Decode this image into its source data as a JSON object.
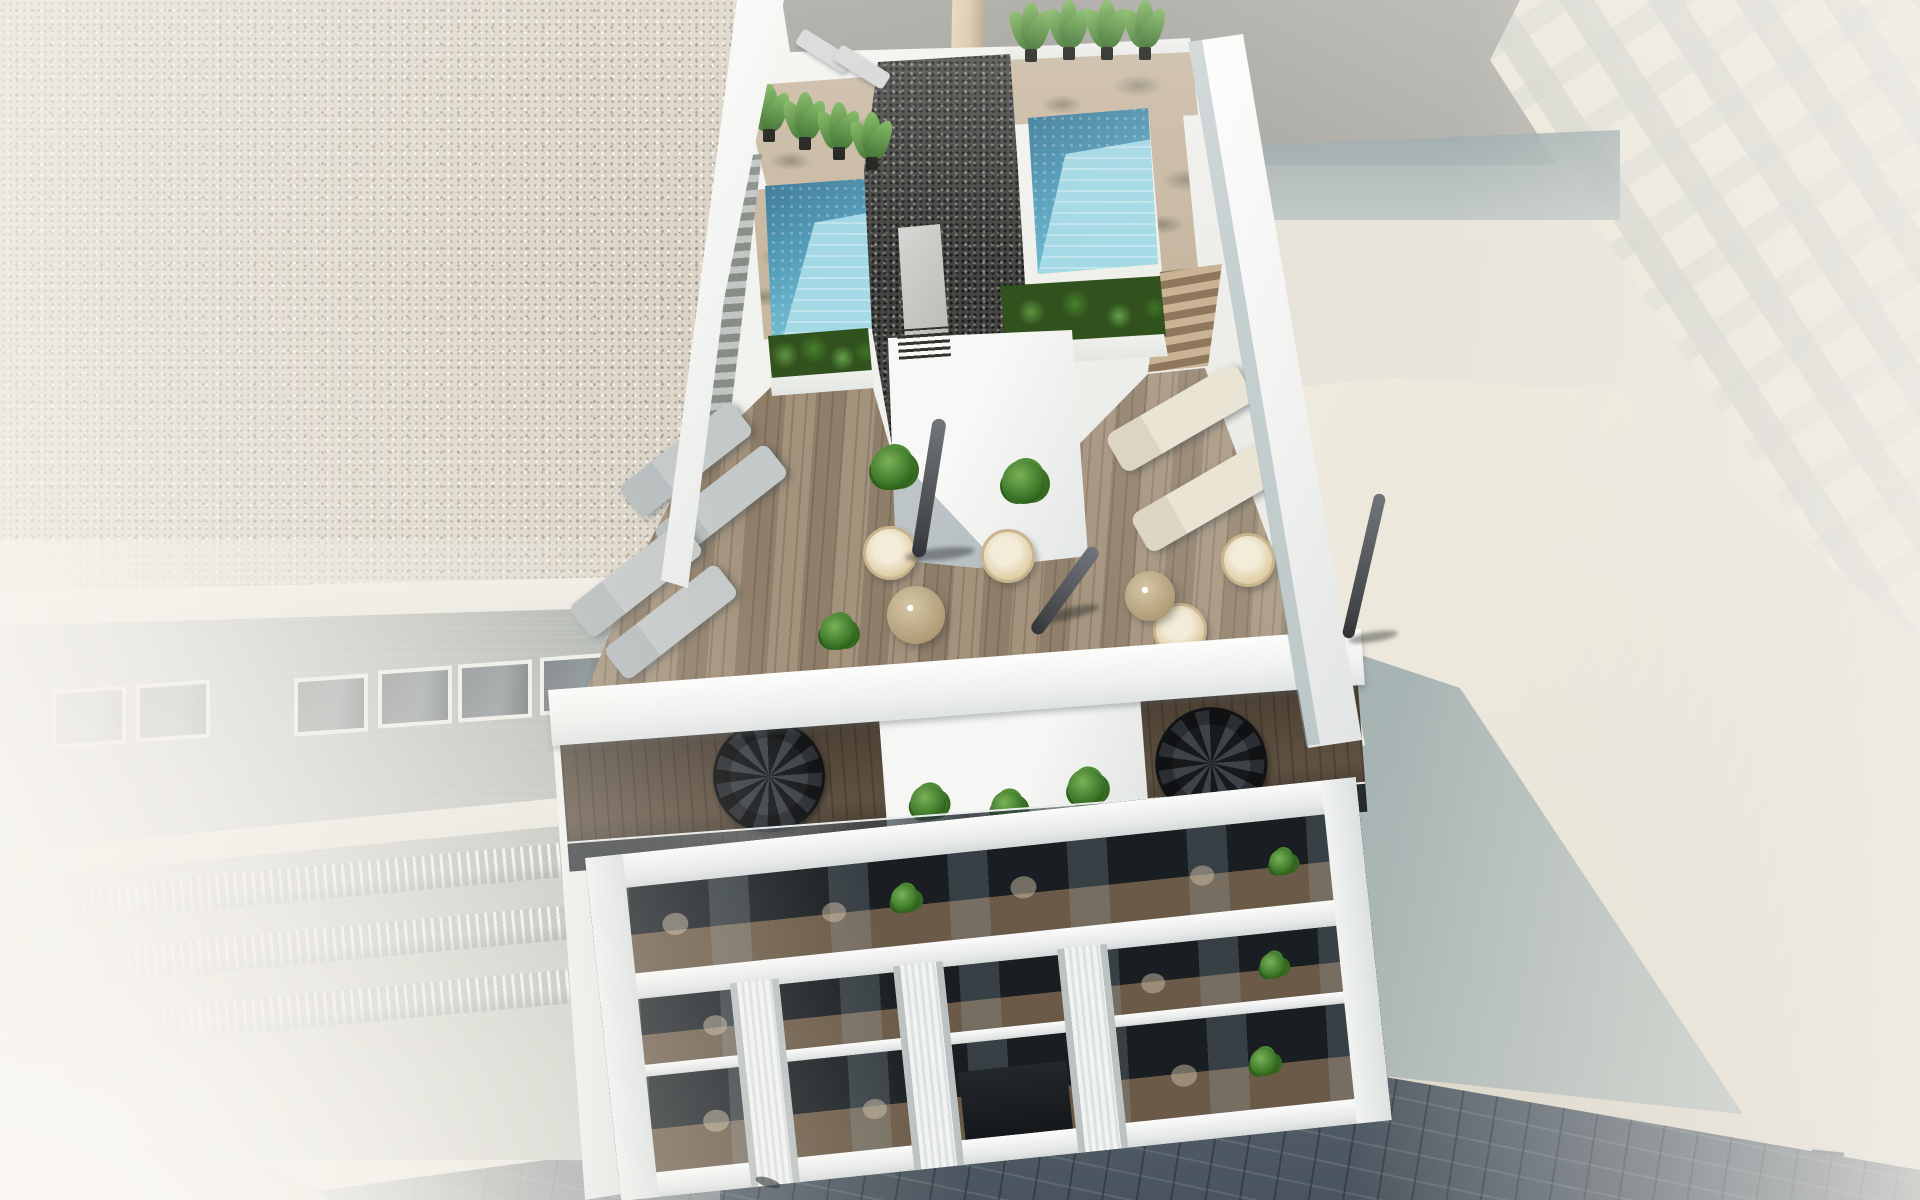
{
  "scene": {
    "caption": "Aerial 3D architectural rendering, bright daylight: a modern white apartment building seen from above with a rooftop terrace holding two turquoise plunge pools, a dark gravel stair-core roof with a louvered vent box, banana plants in planters, wooden sun decks with gray and cream loungers, rattan hanging chairs, round tables and closed parasols; below, duplex balconies with black spiral staircases, then three balcony floors with glass balustrades and ribbed white pilasters over a dark cobbled street; a speckled-roof neighbour building with brick facade and balconies fades into haze on the left, and washed-out white buildings with a teal roof shadow fill the right."
  },
  "palette": {
    "sky_gray": "#a5a39d",
    "beam_tan": "#d9c3a4",
    "speckle_base": "#dbd4c7",
    "gravel_base": "#454543",
    "pool_deep": "#2f6f90",
    "pool_mid": "#6fb9cf",
    "pool_light": "#7ec6d8",
    "pool_steps": "#a9dde8",
    "deck_tan": "#c8b8a2",
    "wood_terrace": "#9b8a75",
    "wood_dark": "#5c4f41",
    "white_wall": "#f3f4f2",
    "teal_shadow": "#6e8c96",
    "right_roof": "#ebe7da",
    "street_dark": "#49545e",
    "pavement": "#cfc8bb",
    "brick": "#a7ada9",
    "glass_dark": "#2e373e",
    "plant_green": "#4e8138",
    "lounger_gray": "#c3c8c8",
    "lounger_cream": "#eae4d5",
    "rattan": "#c9b48e",
    "umbrella_gray": "#5b5f61"
  },
  "objects": {
    "pools": 2,
    "gray_loungers": 6,
    "cream_loungers": 2,
    "hanging_chairs": 4,
    "round_tables": 2,
    "closed_parasols": 3,
    "spiral_staircases": 2,
    "banana_plants": 8,
    "planters": 4,
    "rooftop_staircases": 2,
    "facade_pilasters": 3,
    "balcony_floors": 3
  }
}
